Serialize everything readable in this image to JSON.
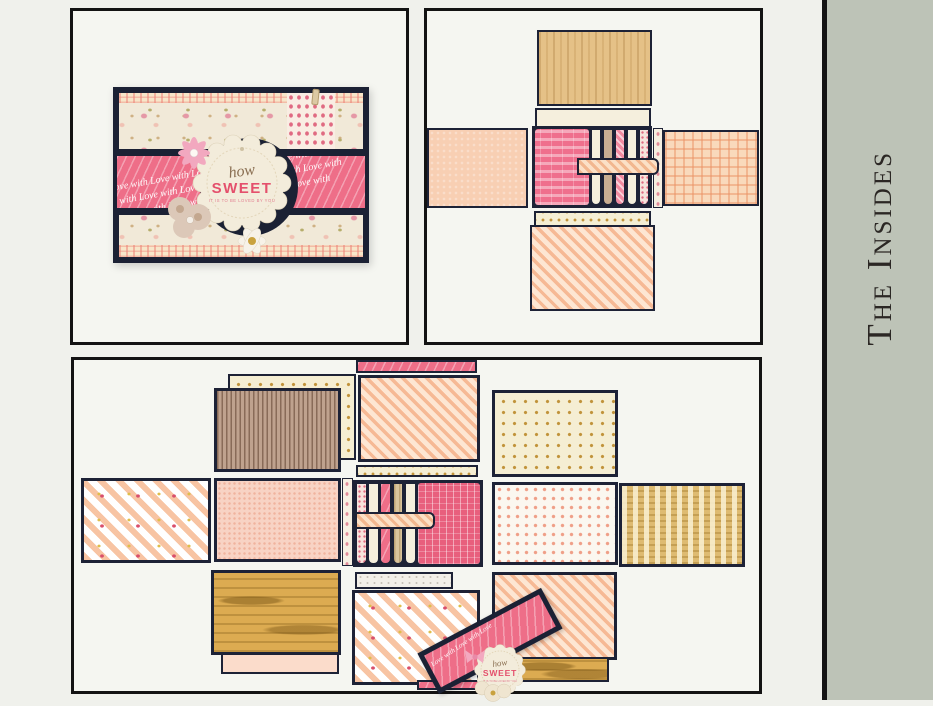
{
  "page": {
    "background": "#f0f1ec"
  },
  "sidebar": {
    "label": "The Insides",
    "background": "#bdc3b7",
    "text_color": "#2b2724",
    "rule_color": "#141414"
  },
  "frames": {
    "border_color": "#131313",
    "background": "#f5f6f1"
  },
  "colors": {
    "navy": "#1d2236",
    "pink_band": "#ee6e88",
    "sweet_pink": "#e4506c",
    "cream_tag": "#f3ecdb",
    "wood_tan": "#e5c187",
    "wood_gold": "#dcab51",
    "peach": "#f8cfb3",
    "sage": "#bdc3b7"
  },
  "photo_closed_box": {
    "alt": "Closed mini-album box with floral paper, pink love band, flowers and scalloped tag",
    "band_text": "Love with Love with Love with Love with Love with Love with",
    "tag": {
      "script": "how",
      "word": "SWEET",
      "subtext": "IT IS TO BE LOVED BY YOU"
    }
  },
  "photo_open_box": {
    "alt": "Box partially opened showing four printed flaps and a tabbed page stack",
    "panels": [
      "wood-grain top flap",
      "cream liner strip",
      "solid peach left flap",
      "peach plaid right flap",
      "pink page stack with rounded tabs",
      "peach striped belly band",
      "gold-dot border strip",
      "peach diagonal-stripe bottom flap"
    ]
  },
  "photo_exploded": {
    "alt": "Box fully opened flat showing all patterned inside panels",
    "panels": [
      "pink love ribbon strip",
      "gold-dot cream panel",
      "taupe pinstripe panel",
      "peach diagonal-stripe panel",
      "gold-dot border strip",
      "gold-dot cream panel",
      "floral chevron panel",
      "peach dotted panel",
      "floral spine strip",
      "page stack with peach belly band",
      "white pink-dot panel",
      "woven tan panel",
      "gold wood-grain panel",
      "white speckle strip",
      "peach diagonal-stripe panel",
      "floral chevron base panel",
      "wood-grain strip",
      "pink ribbon strip",
      "navy box lid with love band"
    ],
    "lid_band_text": "Love with Love with Love",
    "lid_tag": {
      "script": "how",
      "word": "SWEET",
      "subtext": "IT IS TO BE LOVED BY YOU"
    }
  }
}
